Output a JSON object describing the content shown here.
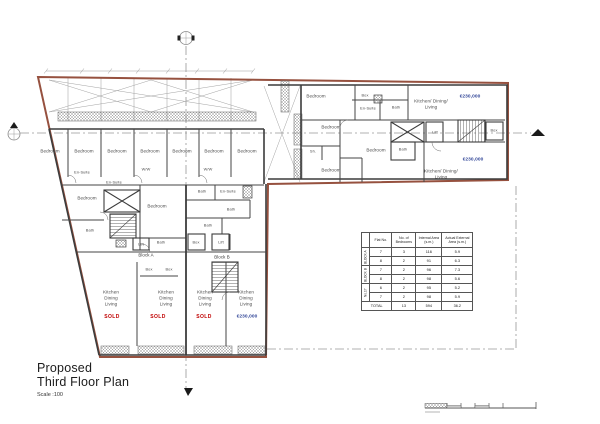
{
  "title": {
    "line1": "Proposed",
    "line2": "Third Floor Plan",
    "scale_note": "Scale :100"
  },
  "colors": {
    "boundary": "#96513f",
    "wall": "#3c3c3c",
    "sold": "#c00000",
    "price": "#2e4396",
    "label": "#4a4a4a"
  },
  "plan_labels": [
    {
      "t": "Bedroom",
      "x": 50,
      "y": 151,
      "k": "room"
    },
    {
      "t": "Bedroom",
      "x": 84,
      "y": 151,
      "k": "room"
    },
    {
      "t": "Bedroom",
      "x": 117,
      "y": 151,
      "k": "room"
    },
    {
      "t": "Bedroom",
      "x": 150,
      "y": 151,
      "k": "room"
    },
    {
      "t": "Bedroom",
      "x": 182,
      "y": 151,
      "k": "room"
    },
    {
      "t": "Bedroom",
      "x": 214,
      "y": 151,
      "k": "room"
    },
    {
      "t": "Bedroom",
      "x": 247,
      "y": 151,
      "k": "room"
    },
    {
      "t": "Bedroom",
      "x": 87,
      "y": 198,
      "k": "room"
    },
    {
      "t": "Bedroom",
      "x": 157,
      "y": 206,
      "k": "room"
    },
    {
      "t": "Bedroom",
      "x": 316,
      "y": 96,
      "k": "room"
    },
    {
      "t": "Bedroom",
      "x": 331,
      "y": 127,
      "k": "room"
    },
    {
      "t": "Bedroom",
      "x": 376,
      "y": 150,
      "k": "room"
    },
    {
      "t": "Bedroom",
      "x": 331,
      "y": 170,
      "k": "room"
    },
    {
      "t": "En-Suite",
      "x": 82,
      "y": 172,
      "k": "tiny"
    },
    {
      "t": "En-Suite",
      "x": 114,
      "y": 182,
      "k": "tiny"
    },
    {
      "t": "En-Suite",
      "x": 228,
      "y": 191,
      "k": "tiny"
    },
    {
      "t": "En-Suite",
      "x": 368,
      "y": 108,
      "k": "tiny"
    },
    {
      "t": "W/W",
      "x": 146,
      "y": 169,
      "k": "tiny"
    },
    {
      "t": "W/W",
      "x": 208,
      "y": 169,
      "k": "tiny"
    },
    {
      "t": "Bath",
      "x": 90,
      "y": 230,
      "k": "tiny"
    },
    {
      "t": "Bath",
      "x": 202,
      "y": 191,
      "k": "tiny"
    },
    {
      "t": "Bath",
      "x": 231,
      "y": 209,
      "k": "tiny"
    },
    {
      "t": "Bath",
      "x": 208,
      "y": 225,
      "k": "tiny"
    },
    {
      "t": "Bath",
      "x": 161,
      "y": 242,
      "k": "tiny"
    },
    {
      "t": "Bath",
      "x": 396,
      "y": 107,
      "k": "tiny"
    },
    {
      "t": "Bath",
      "x": 403,
      "y": 149,
      "k": "tiny"
    },
    {
      "t": "Sh.",
      "x": 313,
      "y": 151,
      "k": "tiny"
    },
    {
      "t": "Lift",
      "x": 141,
      "y": 244,
      "k": "tiny"
    },
    {
      "t": "Lift",
      "x": 221,
      "y": 242,
      "k": "tiny"
    },
    {
      "t": "Lift",
      "x": 435,
      "y": 132,
      "k": "tiny"
    },
    {
      "t": "Box",
      "x": 365,
      "y": 95,
      "k": "tiny"
    },
    {
      "t": "Box",
      "x": 196,
      "y": 242,
      "k": "tiny"
    },
    {
      "t": "Box",
      "x": 149,
      "y": 269,
      "k": "tiny"
    },
    {
      "t": "Box",
      "x": 169,
      "y": 269,
      "k": "tiny"
    },
    {
      "t": "Box",
      "x": 494,
      "y": 130,
      "k": "tiny"
    },
    {
      "t": "Block A",
      "x": 146,
      "y": 255,
      "k": "block"
    },
    {
      "t": "Block B",
      "x": 222,
      "y": 257,
      "k": "block"
    },
    {
      "t": "Kitchen",
      "x": 111,
      "y": 292,
      "k": "room"
    },
    {
      "t": "Dining",
      "x": 111,
      "y": 298,
      "k": "room"
    },
    {
      "t": "Living",
      "x": 111,
      "y": 304,
      "k": "room"
    },
    {
      "t": "Kitchen",
      "x": 166,
      "y": 292,
      "k": "room"
    },
    {
      "t": "Dining",
      "x": 166,
      "y": 298,
      "k": "room"
    },
    {
      "t": "Living",
      "x": 166,
      "y": 304,
      "k": "room"
    },
    {
      "t": "Kitchen",
      "x": 205,
      "y": 292,
      "k": "room"
    },
    {
      "t": "Dining",
      "x": 205,
      "y": 298,
      "k": "room"
    },
    {
      "t": "Living",
      "x": 205,
      "y": 304,
      "k": "room"
    },
    {
      "t": "Kitchen",
      "x": 246,
      "y": 292,
      "k": "room"
    },
    {
      "t": "Dining",
      "x": 246,
      "y": 298,
      "k": "room"
    },
    {
      "t": "Living",
      "x": 246,
      "y": 304,
      "k": "room"
    },
    {
      "t": "Kitchen/ Dining/",
      "x": 431,
      "y": 101,
      "k": "room"
    },
    {
      "t": "Living",
      "x": 431,
      "y": 107,
      "k": "room"
    },
    {
      "t": "Kitchen/ Dining/",
      "x": 441,
      "y": 171,
      "k": "room"
    },
    {
      "t": "Living",
      "x": 441,
      "y": 177,
      "k": "room"
    },
    {
      "t": "SOLD",
      "x": 112,
      "y": 317,
      "k": "sold"
    },
    {
      "t": "SOLD",
      "x": 158,
      "y": 317,
      "k": "sold"
    },
    {
      "t": "SOLD",
      "x": 204,
      "y": 317,
      "k": "sold"
    },
    {
      "t": "€230,000",
      "x": 247,
      "y": 317,
      "k": "price"
    },
    {
      "t": "€230,000",
      "x": 470,
      "y": 97,
      "k": "price"
    },
    {
      "t": "€230,000",
      "x": 473,
      "y": 160,
      "k": "price"
    }
  ],
  "table": {
    "col_headers": [
      "Flat No.",
      "No. of Bedrooms",
      "Internal Area (s.m.)",
      "Actual External Area (s.m.)"
    ],
    "groups": [
      {
        "name": "BLOCK A",
        "rows": [
          {
            "flat": "7",
            "bedrooms": "3",
            "internal": "116",
            "external": "5.9"
          },
          {
            "flat": "8",
            "bedrooms": "2",
            "internal": "91",
            "external": "6.3"
          }
        ]
      },
      {
        "name": "BLOCK B",
        "rows": [
          {
            "flat": "7",
            "bedrooms": "2",
            "internal": "96",
            "external": "7.3"
          },
          {
            "flat": "8",
            "bedrooms": "2",
            "internal": "98",
            "external": "5.6"
          }
        ]
      },
      {
        "name": "No.17",
        "rows": [
          {
            "flat": "6",
            "bedrooms": "2",
            "internal": "95",
            "external": "5.2"
          },
          {
            "flat": "7",
            "bedrooms": "2",
            "internal": "98",
            "external": "5.9"
          }
        ]
      }
    ],
    "total": {
      "label": "TOTAL",
      "bedrooms": "13",
      "internal": "594",
      "external": "36.2"
    }
  }
}
